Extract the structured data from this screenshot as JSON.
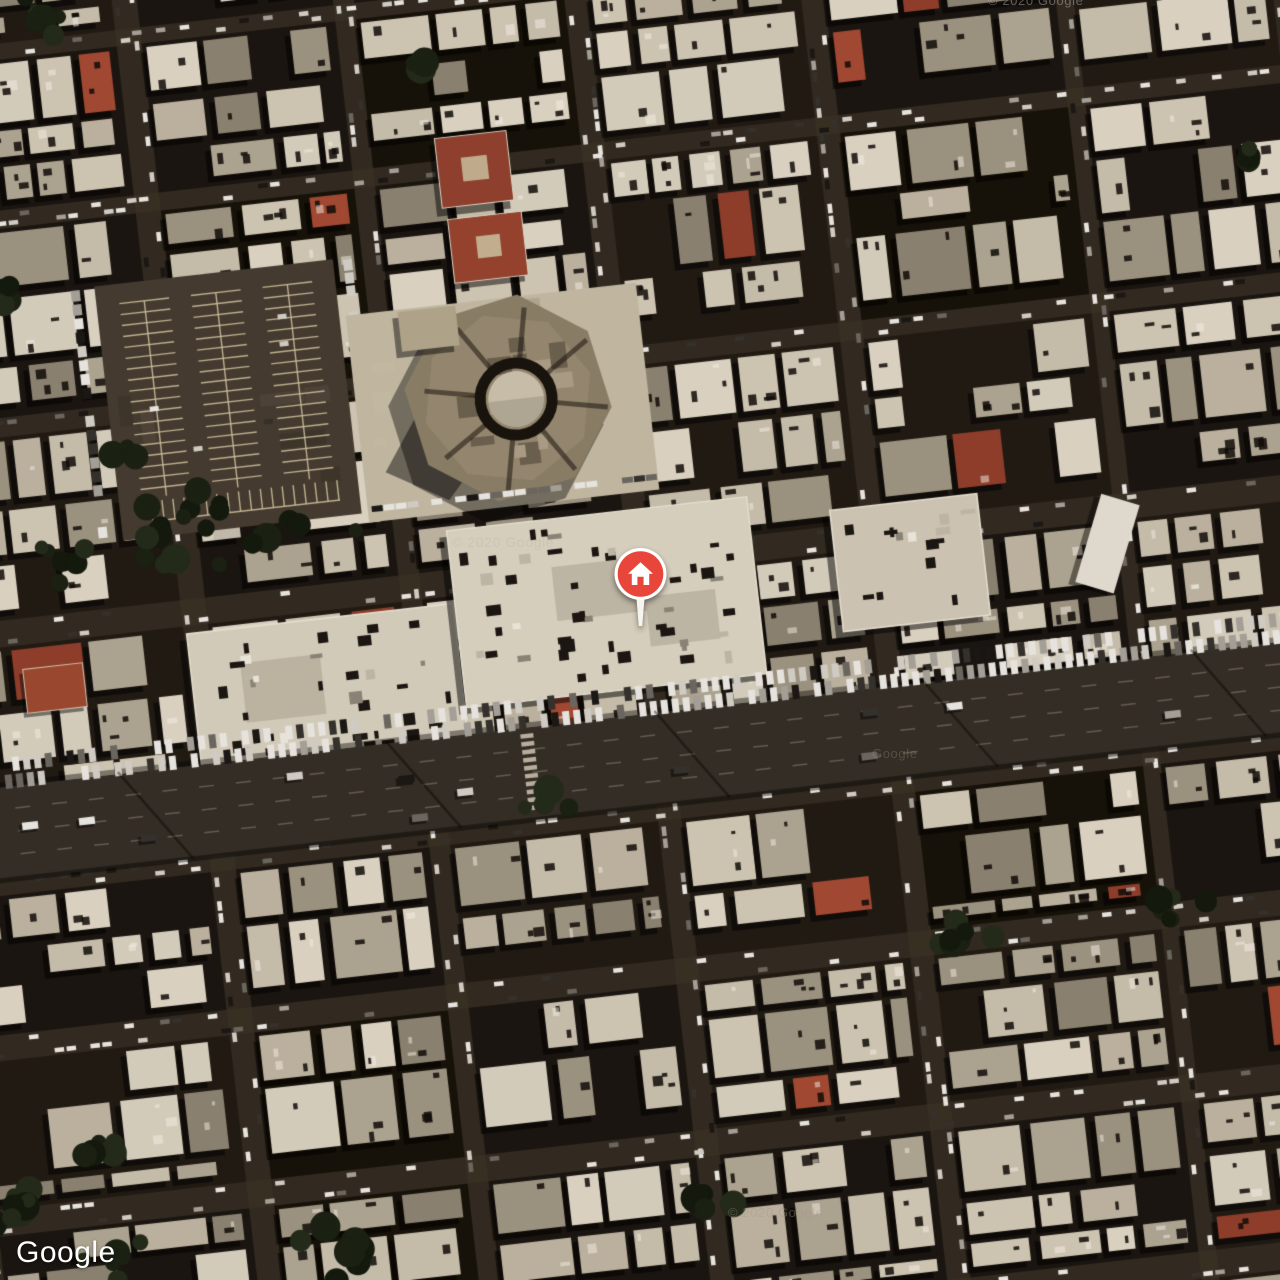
{
  "map": {
    "attribution": {
      "logo_text": "Google"
    },
    "watermarks": {
      "top_right": "© 2020 Google",
      "center": "© 2020 Google",
      "mid_right": "Google",
      "bottom": "© 2020 Google"
    },
    "marker": {
      "icon": "home-pin-icon",
      "color": "#E8463B",
      "ring_color": "#FFFFFF"
    },
    "colors": {
      "pin_red": "#E8463B",
      "building_light": "#ddd5c3",
      "street_dark": "#2b251d",
      "tree_green": "#1c2413",
      "parking_asphalt": "#463d31"
    }
  }
}
